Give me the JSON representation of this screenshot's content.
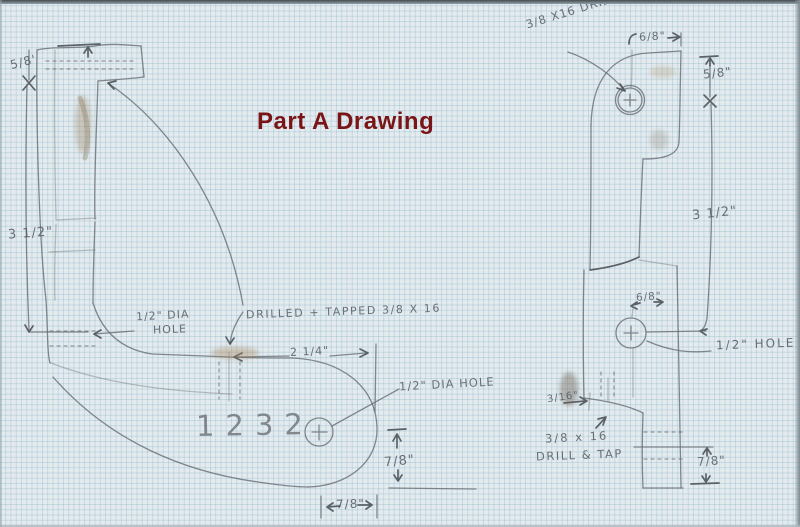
{
  "title": {
    "text": "Part A Drawing",
    "color": "#7a1517"
  },
  "part_number": "1232",
  "left_view": {
    "dim_cap_height": "5/8'",
    "dim_bar_height": "3 1/2\"",
    "side_hole_label_line1": "1/2\" DIA",
    "side_hole_label_line2": "HOLE",
    "tapped_hole_label": "DRILLED + TAPPED  3/8 X 16",
    "dim_foot_length": "2 1/4\"",
    "end_hole_label": "1/2\" DIA HOLE",
    "dim_end_vertical": "7/8\"",
    "dim_end_horizontal": "7/8\""
  },
  "right_view": {
    "tapped_hole_label": "3/8 X16 DRILLED +TAPPED",
    "dim_top_offset": "6/8\"",
    "dim_top_height": "5/8\"",
    "dim_body_height": "3 1/2\"",
    "dim_hole_offset": "6/8\"",
    "hole_label": "1/2\" HOLE",
    "dim_stem_width": "3/16\"",
    "drill_tap_label_line1": "3/8 x 16",
    "drill_tap_label_line2": "DRILL & TAP",
    "dim_foot_height": "7/8\""
  }
}
